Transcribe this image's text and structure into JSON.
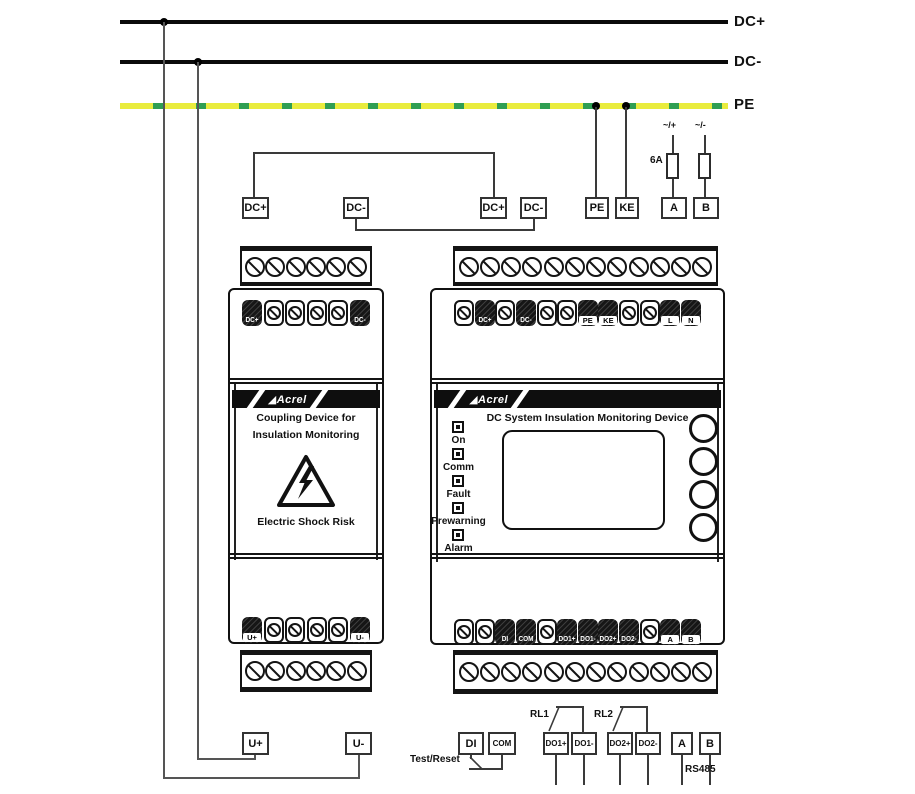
{
  "buses": {
    "dc_plus": "DC+",
    "dc_minus": "DC-",
    "pe": "PE"
  },
  "supply": {
    "ac_plus": "~/+",
    "ac_minus": "~/-",
    "fuse_rating": "6A"
  },
  "top_boxes": {
    "dc_plus_left": "DC+",
    "dc_minus_left": "DC-",
    "dc_plus_right": "DC+",
    "dc_minus_right": "DC-",
    "pe": "PE",
    "ke": "KE",
    "a": "A",
    "b": "B"
  },
  "coupling_device": {
    "brand": "Acrel",
    "name_line1": "Coupling Device for",
    "name_line2": "Insulation Monitoring",
    "warning_text": "Electric Shock Risk",
    "top_terminals": [
      "DC+",
      "DC-"
    ],
    "bottom_terminals": [
      "U+",
      "U-"
    ]
  },
  "monitoring_device": {
    "brand": "Acrel",
    "title": "DC System Insulation Monitoring Device",
    "leds": [
      "On",
      "Comm",
      "Fault",
      "Prewarning",
      "Alarm"
    ],
    "top_row": [
      "DC+",
      "DC-",
      "PE",
      "KE",
      "L",
      "N"
    ],
    "bottom_row": [
      "DI",
      "COM",
      "DO1+",
      "DO1-",
      "DO2+",
      "DO2-",
      "A",
      "B"
    ]
  },
  "bottom_boxes": {
    "u_plus": "U+",
    "u_minus": "U-",
    "di": "DI",
    "com": "COM",
    "do1_plus": "DO1+",
    "do1_minus": "DO1-",
    "do2_plus": "DO2+",
    "do2_minus": "DO2-",
    "a": "A",
    "b": "B"
  },
  "annotations": {
    "test_reset": "Test/Reset",
    "rl1": "RL1",
    "rl2": "RL2",
    "rs485": "RS485"
  },
  "colors": {
    "pe_yellow": "#e9ec3d",
    "pe_green": "#2f9e52",
    "line": "#0a0a0a"
  }
}
